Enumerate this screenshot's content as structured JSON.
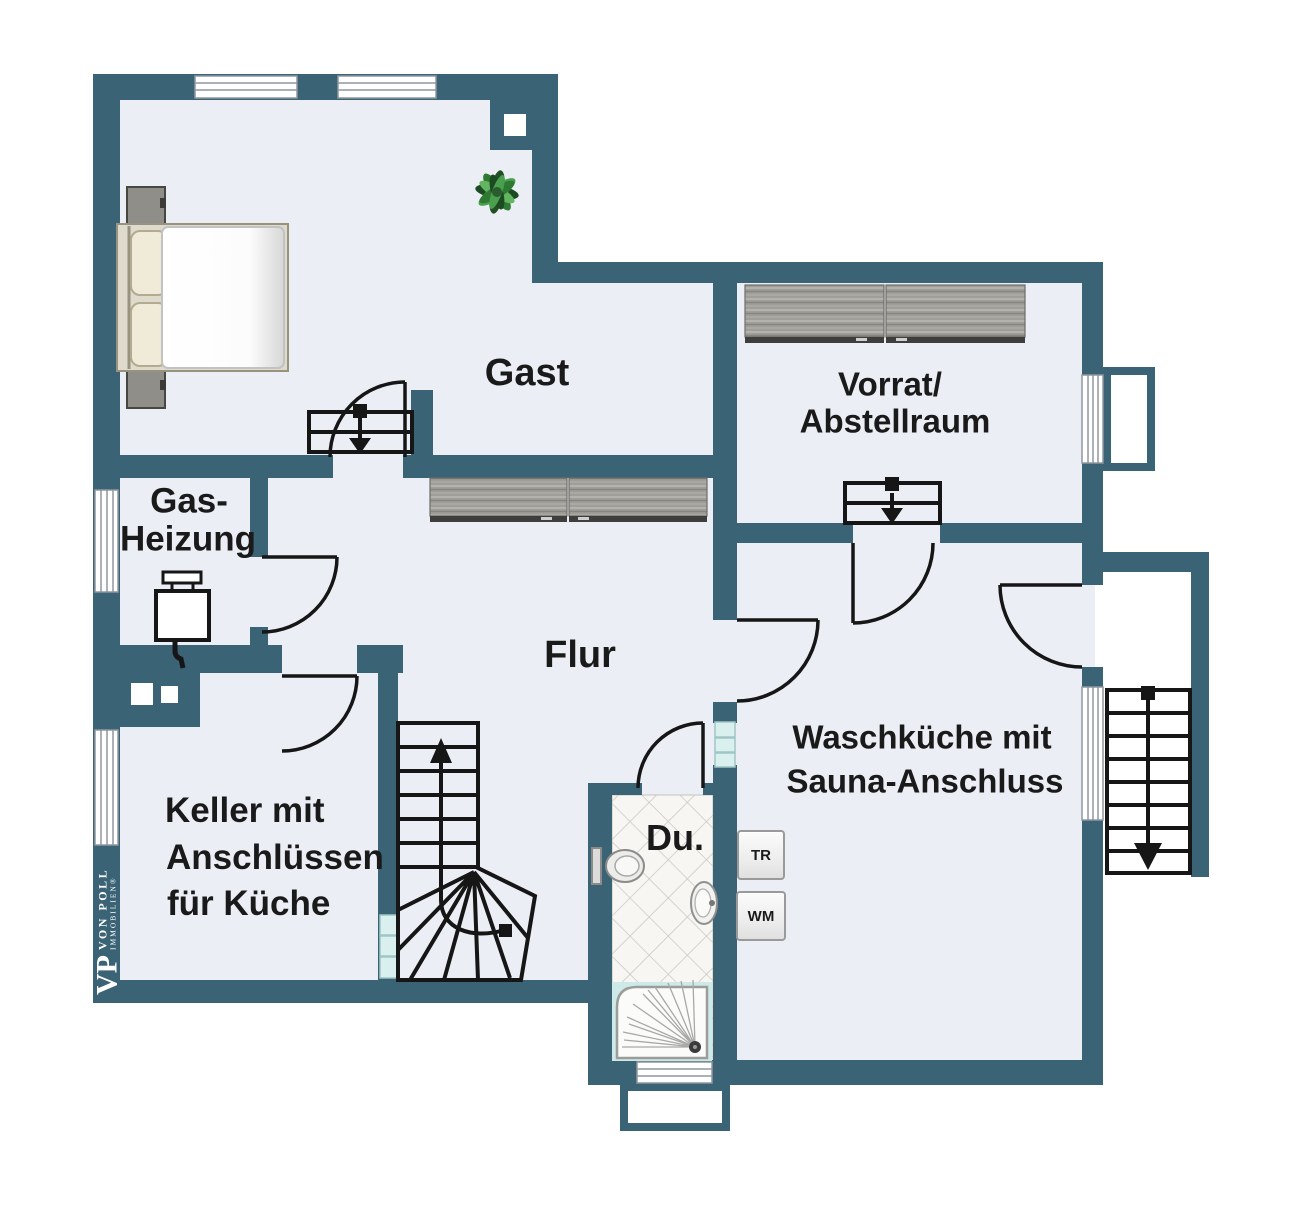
{
  "colors": {
    "wall": "#3a6376",
    "floor": "#ebeff5",
    "line": "#161616",
    "glass_opening": "#d9f0ee",
    "tile_line": "#ccc9c3",
    "plant_green": "#2f7a33"
  },
  "rooms": {
    "gast": {
      "label": "Gast"
    },
    "vorrat": {
      "line1": "Vorrat/",
      "line2": "Abstellraum"
    },
    "gas": {
      "line1": "Gas-",
      "line2": "Heizung"
    },
    "flur": {
      "label": "Flur"
    },
    "keller": {
      "line1": "Keller mit",
      "line2": "Anschlüssen",
      "line3": "für Küche"
    },
    "wasch": {
      "line1": "Waschküche mit",
      "line2": "Sauna-Anschluss"
    },
    "du": {
      "label": "Du."
    }
  },
  "appliances": {
    "dryer_label": "TR",
    "washer_label": "WM"
  },
  "logo": {
    "monogram": "VP",
    "name": "VON POLL",
    "subtitle": "IMMOBILIEN®"
  }
}
